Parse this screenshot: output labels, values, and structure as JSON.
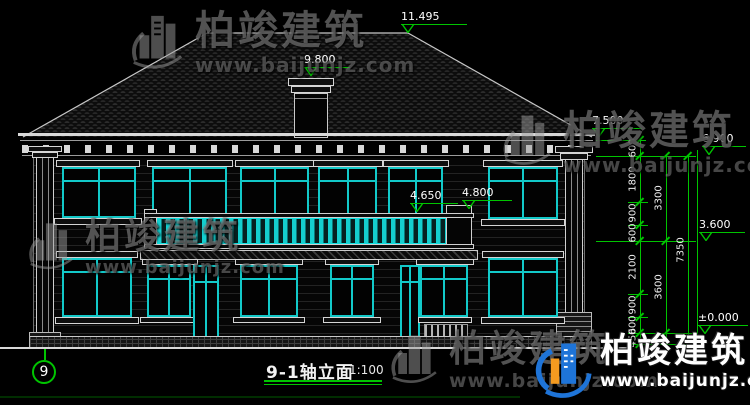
{
  "drawing": {
    "title": "9-1轴立面",
    "scale": "1:100",
    "axis_number": "9",
    "colors": {
      "background": "#000000",
      "cad_green": "#00c400",
      "cad_cyan": "#12c9c9",
      "line_white": "#d9d9d9",
      "watermark_gray": "#969696",
      "logo_blue": "#1e74d8",
      "logo_orange": "#f59b20"
    },
    "elevation_markers": [
      {
        "name": "roof-ridge",
        "value": "11.495"
      },
      {
        "name": "chimney-top",
        "value": "9.800"
      },
      {
        "name": "eave",
        "value": "7.500"
      },
      {
        "name": "cornice-bottom",
        "value": "6.900"
      },
      {
        "name": "balcony-railing",
        "value": "4.650"
      },
      {
        "name": "balcony-post-top",
        "value": "4.800"
      },
      {
        "name": "second-floor",
        "value": "3.600"
      },
      {
        "name": "ground-floor",
        "value": "±0.000"
      }
    ],
    "dimensions": {
      "chain_inner": [
        "600",
        "1800",
        "900",
        "600",
        "2100",
        "900",
        "600",
        "450"
      ],
      "chain_middle": [
        "3300",
        "3600"
      ],
      "chain_outer": [
        "7350"
      ]
    }
  },
  "watermark": {
    "brand_cn": "柏竣建筑",
    "brand_url": "www.baijunjz.com"
  }
}
